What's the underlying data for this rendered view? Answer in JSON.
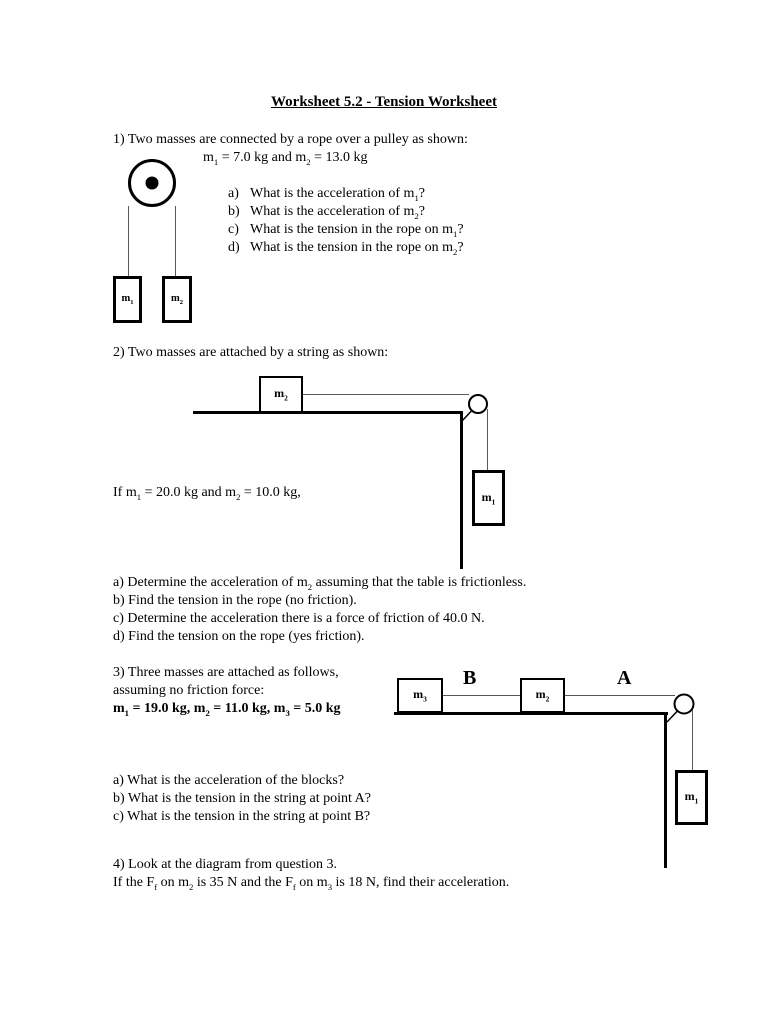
{
  "title": "Worksheet 5.2 - Tension Worksheet",
  "colors": {
    "ink": "#000000",
    "paper": "#ffffff",
    "string_gray": "#595959"
  },
  "p1": {
    "prompt": "1) Two masses are connected by a rope over a pulley as shown:",
    "given_parts": [
      {
        "t": "m"
      },
      {
        "t": "1",
        "sub": true
      },
      {
        "t": " = 7.0 kg and m"
      },
      {
        "t": "2",
        "sub": true
      },
      {
        "t": " = 13.0 kg"
      }
    ],
    "questions": [
      {
        "label": "a)",
        "parts": [
          {
            "t": "What is the acceleration of m"
          },
          {
            "t": "1",
            "sub": true
          },
          {
            "t": "?"
          }
        ]
      },
      {
        "label": "b)",
        "parts": [
          {
            "t": "What is the acceleration of m"
          },
          {
            "t": "2",
            "sub": true
          },
          {
            "t": "?"
          }
        ]
      },
      {
        "label": "c)",
        "parts": [
          {
            "t": "What is the tension in the rope on m"
          },
          {
            "t": "1",
            "sub": true
          },
          {
            "t": "?"
          }
        ]
      },
      {
        "label": "d)",
        "parts": [
          {
            "t": "What is the tension in the rope on m"
          },
          {
            "t": "2",
            "sub": true
          },
          {
            "t": "?"
          }
        ]
      }
    ],
    "diagram": {
      "mass1_parts": [
        {
          "t": "m"
        },
        {
          "t": "1",
          "sub": true
        }
      ],
      "mass2_parts": [
        {
          "t": "m"
        },
        {
          "t": "2",
          "sub": true
        }
      ]
    }
  },
  "p2": {
    "prompt": "2) Two masses are attached by a string as shown:",
    "given_parts": [
      {
        "t": "If m"
      },
      {
        "t": "1",
        "sub": true
      },
      {
        "t": " = 20.0 kg and m"
      },
      {
        "t": "2",
        "sub": true
      },
      {
        "t": " = 10.0 kg,"
      }
    ],
    "questions": [
      {
        "parts": [
          {
            "t": "a) Determine the acceleration of m"
          },
          {
            "t": "2",
            "sub": true
          },
          {
            "t": " assuming that the table is frictionless."
          }
        ]
      },
      {
        "parts": [
          {
            "t": "b) Find the tension in the rope (no friction)."
          }
        ]
      },
      {
        "parts": [
          {
            "t": "c) Determine the acceleration there is a force of friction of 40.0 N."
          }
        ]
      },
      {
        "parts": [
          {
            "t": "d) Find the tension on the rope (yes friction)."
          }
        ]
      }
    ],
    "diagram": {
      "mass2_parts": [
        {
          "t": "m"
        },
        {
          "t": "2",
          "sub": true
        }
      ],
      "mass1_parts": [
        {
          "t": "m"
        },
        {
          "t": "1",
          "sub": true
        }
      ]
    }
  },
  "p3": {
    "line1": "3) Three masses are attached as follows,",
    "line2": "assuming no friction force:",
    "given_parts": [
      {
        "t": "m"
      },
      {
        "t": "1",
        "sub": true
      },
      {
        "t": " = 19.0 kg, m"
      },
      {
        "t": "2",
        "sub": true
      },
      {
        "t": " = 11.0 kg, m"
      },
      {
        "t": "3",
        "sub": true
      },
      {
        "t": " = 5.0 kg"
      }
    ],
    "questions": [
      {
        "parts": [
          {
            "t": "a) What is the acceleration of the blocks?"
          }
        ]
      },
      {
        "parts": [
          {
            "t": "b) What is the tension in the string at point A?"
          }
        ]
      },
      {
        "parts": [
          {
            "t": "c) What is the tension in the string at point B?"
          }
        ]
      }
    ],
    "diagram": {
      "mass3_parts": [
        {
          "t": "m"
        },
        {
          "t": "3",
          "sub": true
        }
      ],
      "mass2_parts": [
        {
          "t": "m"
        },
        {
          "t": "2",
          "sub": true
        }
      ],
      "mass1_parts": [
        {
          "t": "m"
        },
        {
          "t": "1",
          "sub": true
        }
      ],
      "point_b": "B",
      "point_a": "A"
    }
  },
  "p4": {
    "line1": "4) Look at the diagram from question 3.",
    "line2_parts": [
      {
        "t": "If the F"
      },
      {
        "t": "f",
        "sub": true
      },
      {
        "t": " on m"
      },
      {
        "t": "2",
        "sub": true
      },
      {
        "t": " is 35 N and the F"
      },
      {
        "t": "f",
        "sub": true
      },
      {
        "t": " on m"
      },
      {
        "t": "3",
        "sub": true
      },
      {
        "t": " is 18 N, find their acceleration."
      }
    ]
  }
}
